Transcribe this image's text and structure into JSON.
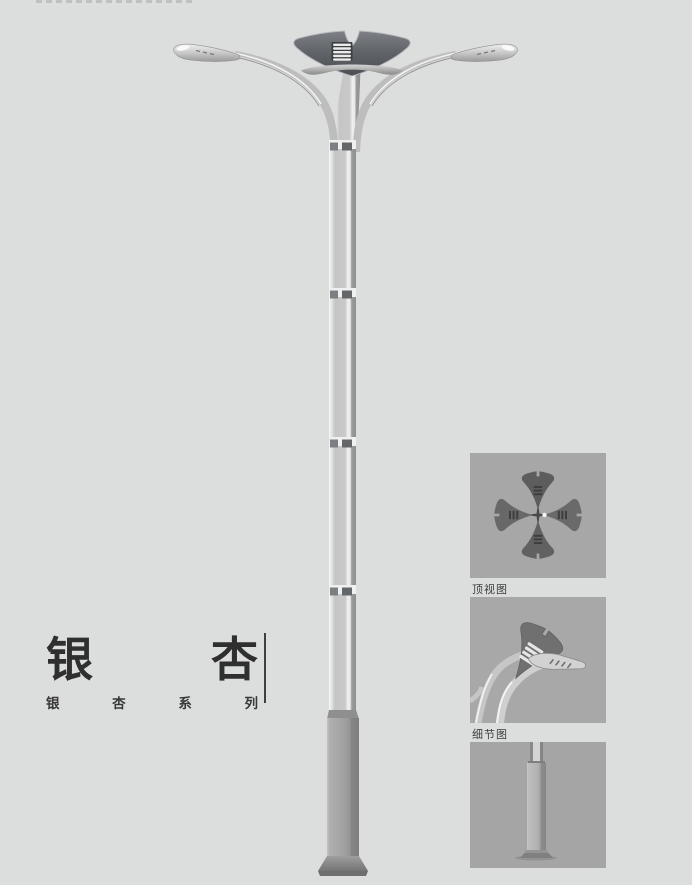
{
  "colors": {
    "page_background": "#dcdddd",
    "panel_background": "#a8a8a8",
    "lamp_dark": "#575b60",
    "lamp_metal": "#c6c6c6",
    "title_text": "#2f2f2f",
    "label_text": "#3c3c3c"
  },
  "title": {
    "text": "银杏",
    "chars": [
      "银",
      "杏"
    ],
    "series_text": "银杏系列",
    "series_chars": [
      "银",
      "杏",
      "系",
      "列"
    ]
  },
  "figures": [
    {
      "label": "顶视图"
    },
    {
      "label": "细节图"
    },
    {
      "label": ""
    }
  ]
}
